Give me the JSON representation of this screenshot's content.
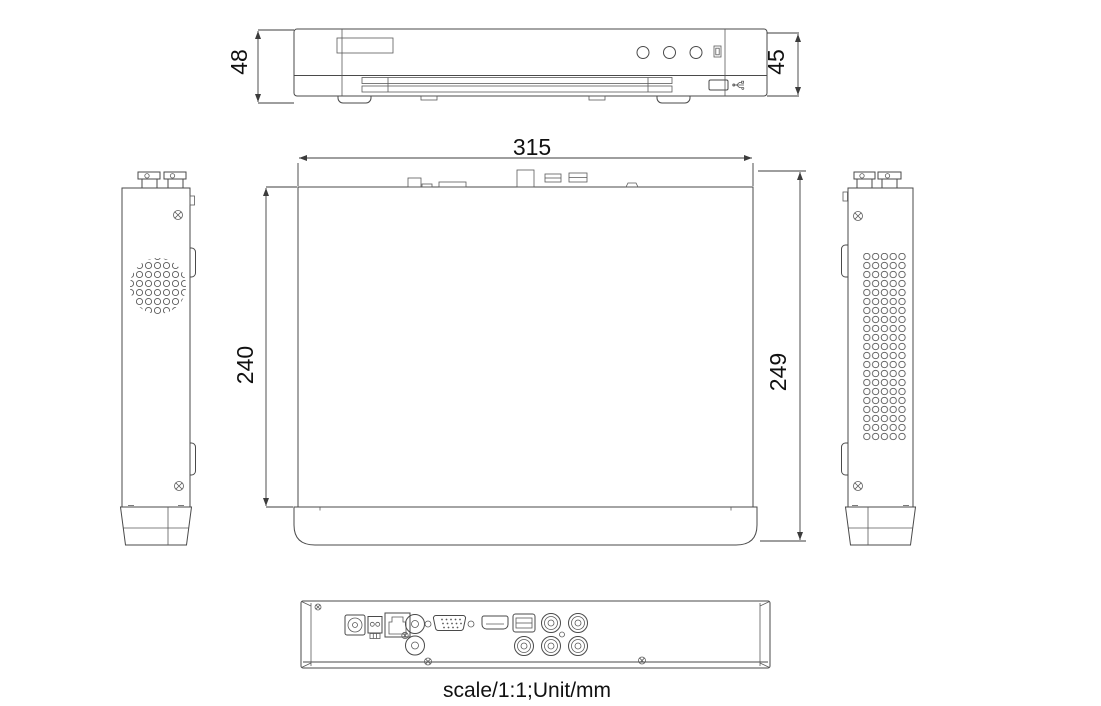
{
  "drawing": {
    "type": "technical-dimension-drawing",
    "subject": "DVR/NVR recorder, five orthographic views",
    "dimensions": {
      "front_height_with_feet": "48",
      "front_panel_height": "45",
      "top_width": "315",
      "top_depth": "240",
      "side_depth_total": "249"
    },
    "footer": {
      "note": "scale/1:1;Unit/mm"
    },
    "colors": {
      "line": "#4a4a4a",
      "text": "#111111",
      "background": "#ffffff"
    },
    "views": {
      "front": "front view with label plate, 3 LED indicators, IR window, vent slots, USB port",
      "top": "top view with rear connector profiles",
      "left_side": "left side view with round vent and BNC connectors",
      "right_side": "right side view with rectangular vent and BNC connectors",
      "rear": "rear view with DC jack, terminal, RJ45, RCA, VGA, HDMI, USB, 5 BNC connectors"
    }
  }
}
